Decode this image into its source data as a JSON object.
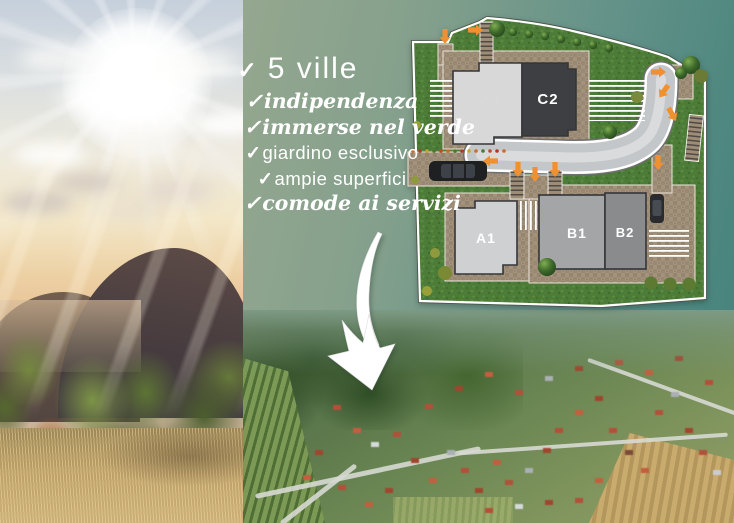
{
  "background": {
    "sage": "#95a78f",
    "teal": "#47837b"
  },
  "promo": {
    "check": "✓",
    "title": "5 ville",
    "features": [
      {
        "text": "indipendenza"
      },
      {
        "text": "immerse nel verde"
      },
      {
        "text": "giardino esclusivo"
      },
      {
        "text": "ampie superfici"
      },
      {
        "text": "comode ai servizi"
      }
    ]
  },
  "site_plan": {
    "buildings": [
      {
        "label": "C1",
        "color": "#d7d8d7"
      },
      {
        "label": "C2",
        "color": "#3e3f43"
      },
      {
        "label": "A1",
        "color": "#cfd0d2"
      },
      {
        "label": "B1",
        "color": "#a4a5a7"
      },
      {
        "label": "B2",
        "color": "#8a8b8d"
      }
    ],
    "colors": {
      "grass": "#4d7c38",
      "road": "#c4c7c9",
      "pavement": "#a3927c",
      "entry_arrow": "#f0912f",
      "outline": "#ffffff"
    }
  }
}
